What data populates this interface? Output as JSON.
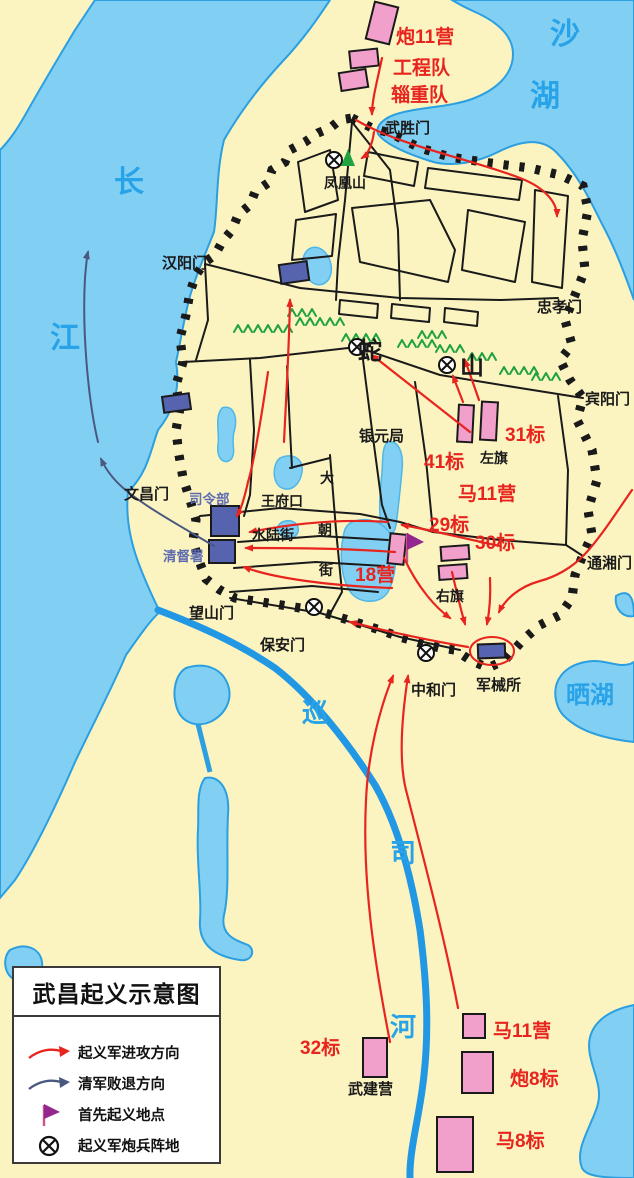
{
  "title": "武昌起义示意图",
  "legend": {
    "items": [
      {
        "id": "attack-arrow",
        "label": "起义军进攻方向"
      },
      {
        "id": "retreat-arrow",
        "label": "清军败退方向"
      },
      {
        "id": "first-uprising-flag",
        "label": "首先起义地点"
      },
      {
        "id": "artillery-position",
        "label": "起义军炮兵阵地"
      }
    ]
  },
  "colors": {
    "background": "#FBF4C1",
    "water": "#82CFF4",
    "water_edge": "#2B9FE0",
    "river": "#2297E3",
    "attack_red": "#E8241E",
    "retreat_slate": "#4A5880",
    "unit_pink": "#F19FCB",
    "qing_building_blue": "#5663AE",
    "mountain_green": "#1FA23F",
    "flag_purple": "#93278F"
  },
  "map": {
    "water_labels": [
      {
        "id": "changjiang-1",
        "text": "长",
        "x": 114,
        "y": 192,
        "size": 30
      },
      {
        "id": "changjiang-2",
        "text": "江",
        "x": 50,
        "y": 348,
        "size": 30
      },
      {
        "id": "shahu-1",
        "text": "沙",
        "x": 550,
        "y": 44,
        "size": 30
      },
      {
        "id": "shahu-2",
        "text": "湖",
        "x": 530,
        "y": 106,
        "size": 30
      },
      {
        "id": "shaihu",
        "text": "晒湖",
        "x": 566,
        "y": 703,
        "size": 24
      },
      {
        "id": "xunsihe-1",
        "text": "巡",
        "x": 302,
        "y": 722,
        "size": 26
      },
      {
        "id": "xunsihe-2",
        "text": "司",
        "x": 390,
        "y": 862,
        "size": 26
      },
      {
        "id": "xunsihe-3",
        "text": "河",
        "x": 390,
        "y": 1036,
        "size": 26
      }
    ],
    "gate_labels": [
      {
        "id": "wusheng-gate",
        "text": "武胜门",
        "x": 385,
        "y": 133,
        "size": 15
      },
      {
        "id": "hanyang-gate",
        "text": "汉阳门",
        "x": 162,
        "y": 268,
        "size": 15
      },
      {
        "id": "zhongxiao-gate",
        "text": "忠孝门",
        "x": 537,
        "y": 312,
        "size": 15
      },
      {
        "id": "binyang-gate",
        "text": "宾阳门",
        "x": 585,
        "y": 404,
        "size": 15
      },
      {
        "id": "tongxiang-gate",
        "text": "通湘门",
        "x": 587,
        "y": 568,
        "size": 15
      },
      {
        "id": "wenchang-gate",
        "text": "文昌门",
        "x": 124,
        "y": 499,
        "size": 15
      },
      {
        "id": "wangshan-gate",
        "text": "望山门",
        "x": 189,
        "y": 618,
        "size": 15
      },
      {
        "id": "baoan-gate",
        "text": "保安门",
        "x": 260,
        "y": 650,
        "size": 15
      },
      {
        "id": "zhonghe-gate",
        "text": "中和门",
        "x": 411,
        "y": 695,
        "size": 15
      }
    ],
    "place_labels": [
      {
        "id": "fenghuang-hill",
        "text": "凤凰山",
        "x": 324,
        "y": 188,
        "size": 14
      },
      {
        "id": "she-hill-1",
        "text": "蛇",
        "x": 358,
        "y": 359,
        "size": 24
      },
      {
        "id": "she-hill-2",
        "text": "山",
        "x": 460,
        "y": 374,
        "size": 24
      },
      {
        "id": "yinyuanju",
        "text": "银元局",
        "x": 359,
        "y": 441,
        "size": 15
      },
      {
        "id": "wangfukou",
        "text": "王府口",
        "x": 261,
        "y": 506,
        "size": 14
      },
      {
        "id": "dachaojie-1",
        "text": "大",
        "x": 320,
        "y": 483,
        "size": 14
      },
      {
        "id": "dachaojie-2",
        "text": "朝",
        "x": 318,
        "y": 535,
        "size": 14
      },
      {
        "id": "dachaojie-3",
        "text": "街",
        "x": 319,
        "y": 575,
        "size": 14
      },
      {
        "id": "shuilujie",
        "text": "水陆街",
        "x": 252,
        "y": 540,
        "size": 14
      },
      {
        "id": "zuoqi",
        "text": "左旗",
        "x": 480,
        "y": 463,
        "size": 14
      },
      {
        "id": "youqi",
        "text": "右旗",
        "x": 436,
        "y": 601,
        "size": 14
      },
      {
        "id": "junxiesuo",
        "text": "军械所",
        "x": 476,
        "y": 690,
        "size": 15
      },
      {
        "id": "wujianying",
        "text": "武建营",
        "x": 348,
        "y": 1094,
        "size": 15
      }
    ],
    "qing_labels": [
      {
        "id": "silingbu",
        "text": "司令部",
        "x": 189,
        "y": 504,
        "size": 13.5
      },
      {
        "id": "qingdushu",
        "text": "清督署",
        "x": 163,
        "y": 561,
        "size": 13.5
      }
    ],
    "unit_labels": [
      {
        "id": "pao-11-ying",
        "text": "炮11营",
        "x": 396,
        "y": 43,
        "size": 19
      },
      {
        "id": "gongcheng-dui",
        "text": "工程队",
        "x": 393,
        "y": 74,
        "size": 19
      },
      {
        "id": "zizhong-dui",
        "text": "辎重队",
        "x": 391,
        "y": 101,
        "size": 19
      },
      {
        "id": "31-biao",
        "text": "31标",
        "x": 505,
        "y": 441,
        "size": 19
      },
      {
        "id": "41-biao",
        "text": "41标",
        "x": 424,
        "y": 468,
        "size": 19
      },
      {
        "id": "ma-11-ying",
        "text": "马11营",
        "x": 458,
        "y": 500,
        "size": 19
      },
      {
        "id": "29-biao",
        "text": "29标",
        "x": 429,
        "y": 531,
        "size": 19
      },
      {
        "id": "30-biao",
        "text": "30标",
        "x": 475,
        "y": 549,
        "size": 19
      },
      {
        "id": "18-ying",
        "text": "18营",
        "x": 355,
        "y": 581,
        "size": 19
      },
      {
        "id": "32-biao",
        "text": "32标",
        "x": 300,
        "y": 1054,
        "size": 19
      },
      {
        "id": "ma-11-ying-south",
        "text": "马11营",
        "x": 493,
        "y": 1037,
        "size": 19
      },
      {
        "id": "pao-8-biao",
        "text": "炮8标",
        "x": 510,
        "y": 1085,
        "size": 19
      },
      {
        "id": "ma-8-biao",
        "text": "马8标",
        "x": 496,
        "y": 1147,
        "size": 19
      }
    ],
    "units_pink": [
      {
        "id": "pao-11-ying",
        "x": 370,
        "y": 4,
        "w": 24,
        "h": 38,
        "r": 14
      },
      {
        "id": "gongcheng-dui",
        "x": 350,
        "y": 50,
        "w": 28,
        "h": 17,
        "r": -6
      },
      {
        "id": "zizhong-dui",
        "x": 340,
        "y": 71,
        "w": 27,
        "h": 18,
        "r": -9
      },
      {
        "id": "31-biao-1",
        "x": 458,
        "y": 405,
        "w": 15,
        "h": 37,
        "r": 3
      },
      {
        "id": "31-biao-2",
        "x": 481,
        "y": 402,
        "w": 16,
        "h": 38,
        "r": 3
      },
      {
        "id": "you-qi-1",
        "x": 441,
        "y": 546,
        "w": 28,
        "h": 14,
        "r": -4
      },
      {
        "id": "you-qi-2",
        "x": 439,
        "y": 565,
        "w": 28,
        "h": 14,
        "r": -4
      },
      {
        "id": "gongcheng-ying-18",
        "x": 389,
        "y": 534,
        "w": 16,
        "h": 30,
        "r": 6
      },
      {
        "id": "wu-jian-ying",
        "x": 363,
        "y": 1038,
        "w": 24,
        "h": 39,
        "r": 0
      },
      {
        "id": "ma-11-ying-south",
        "x": 463,
        "y": 1014,
        "w": 22,
        "h": 24,
        "r": 0
      },
      {
        "id": "pao-8-biao",
        "x": 462,
        "y": 1052,
        "w": 31,
        "h": 41,
        "r": 0
      },
      {
        "id": "ma-8-biao",
        "x": 437,
        "y": 1117,
        "w": 36,
        "h": 55,
        "r": 0
      }
    ],
    "buildings_blue": [
      {
        "id": "riverside-building",
        "x": 163,
        "y": 395,
        "w": 27,
        "h": 16,
        "r": -8
      },
      {
        "id": "hanyangmen-building",
        "x": 280,
        "y": 263,
        "w": 28,
        "h": 19,
        "r": -8
      },
      {
        "id": "silingbu-building",
        "x": 211,
        "y": 506,
        "w": 28,
        "h": 30,
        "r": 0
      },
      {
        "id": "qingdushu-building",
        "x": 209,
        "y": 540,
        "w": 26,
        "h": 23,
        "r": 0
      },
      {
        "id": "junxiesuo-building",
        "x": 478,
        "y": 644,
        "w": 27,
        "h": 14,
        "r": -2
      }
    ],
    "artillery_positions": [
      {
        "x": 334,
        "y": 160
      },
      {
        "x": 357,
        "y": 347
      },
      {
        "x": 447,
        "y": 365
      },
      {
        "x": 314,
        "y": 607
      },
      {
        "x": 426,
        "y": 653
      }
    ],
    "first_uprising_flag": {
      "x": 407,
      "y": 533
    },
    "fenghuang_peak": {
      "x": 348,
      "y": 158
    }
  }
}
